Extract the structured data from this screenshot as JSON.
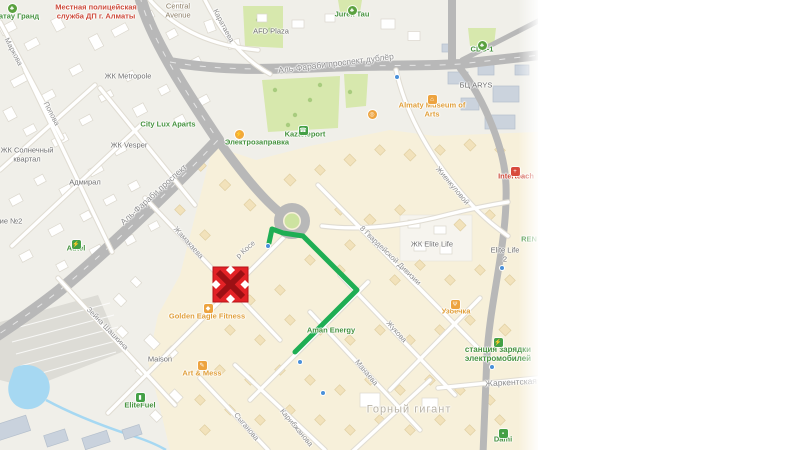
{
  "legend": {
    "notice_icon": "exclamation-circle-icon",
    "blocked_icon": "four-way-arrows-icon",
    "detour_icon": "green-line-icon",
    "blocked_label": "Перекрываемый участок",
    "detour_label": "Объездные пути",
    "colors": {
      "notice_blue": "#4574c6",
      "blocked_red": "#c00d0d",
      "detour_green": "#2eb05e"
    }
  },
  "map": {
    "route_color": "#1fae54",
    "route_points": [
      [
        269,
        243
      ],
      [
        272,
        229
      ],
      [
        283,
        233
      ],
      [
        303,
        236
      ],
      [
        357,
        290
      ],
      [
        295,
        352
      ]
    ],
    "blocked_marker": {
      "x": 230.5,
      "y": 284.5,
      "size": 35,
      "fill": "#e32226",
      "cross": "#9c1014"
    },
    "transit_dots": [
      [
        268,
        246
      ],
      [
        300,
        362
      ],
      [
        323,
        393
      ],
      [
        502,
        268
      ],
      [
        492,
        367
      ],
      [
        397,
        77
      ]
    ],
    "labels": [
      {
        "t": "Местная полицейская\nслужба ДП г. Алматы",
        "x": 96,
        "y": 12,
        "c": "red"
      },
      {
        "t": "атау Гранд",
        "x": 19,
        "y": 17,
        "c": "green"
      },
      {
        "t": "Central\nAvenue",
        "x": 178,
        "y": 11,
        "c": "area"
      },
      {
        "t": "Каратаева",
        "x": 223,
        "y": 26,
        "c": "street",
        "r": 62
      },
      {
        "t": "AFD Plaza",
        "x": 271,
        "y": 32,
        "c": "zk"
      },
      {
        "t": "Jurek Tau",
        "x": 352,
        "y": 15,
        "c": "green"
      },
      {
        "t": "Аль-Фараби проспект дублёр",
        "x": 336,
        "y": 64,
        "c": "street",
        "r": -7,
        "s": 8.5
      },
      {
        "t": "CDC-1",
        "x": 482,
        "y": 50,
        "c": "green"
      },
      {
        "t": "БЦ ARYS",
        "x": 476,
        "y": 86,
        "c": "zk"
      },
      {
        "t": "Almaty Museum of\nArts",
        "x": 432,
        "y": 110,
        "c": "orange"
      },
      {
        "t": "Kazteleport",
        "x": 305,
        "y": 135,
        "c": "green"
      },
      {
        "t": "Электрозаправка",
        "x": 257,
        "y": 143,
        "c": "green"
      },
      {
        "t": "ЖК Metropole",
        "x": 128,
        "y": 77,
        "c": "zk"
      },
      {
        "t": "City Lux Aparts",
        "x": 168,
        "y": 125,
        "c": "green"
      },
      {
        "t": "ЖК Vesper",
        "x": 129,
        "y": 146,
        "c": "zk"
      },
      {
        "t": "ЖК Солнечный\nквартал",
        "x": 27,
        "y": 155,
        "c": "zk"
      },
      {
        "t": "Адмирал",
        "x": 85,
        "y": 183,
        "c": "zk"
      },
      {
        "t": "Маркова",
        "x": 13,
        "y": 52,
        "c": "street",
        "r": 62
      },
      {
        "t": "Попова",
        "x": 51,
        "y": 114,
        "c": "street",
        "r": 62
      },
      {
        "t": "Аль-Фараби проспект",
        "x": 154,
        "y": 195,
        "c": "street",
        "r": -42,
        "s": 8.5
      },
      {
        "t": "ие №2",
        "x": 11,
        "y": 222,
        "c": "zk"
      },
      {
        "t": "Autel",
        "x": 76,
        "y": 249,
        "c": "green"
      },
      {
        "t": "Жамакаева",
        "x": 188,
        "y": 243,
        "c": "street",
        "r": 48
      },
      {
        "t": "р Косе",
        "x": 246,
        "y": 250,
        "c": "street",
        "r": -42
      },
      {
        "t": "8 Гвардейской Дивизии",
        "x": 390,
        "y": 256,
        "c": "street",
        "r": 44
      },
      {
        "t": "Жиенкуловой",
        "x": 452,
        "y": 186,
        "c": "street",
        "r": 50
      },
      {
        "t": "Interteach",
        "x": 516,
        "y": 177,
        "c": "red"
      },
      {
        "t": "ЖК Elite Life",
        "x": 432,
        "y": 245,
        "c": "zk"
      },
      {
        "t": "Elite Life 2",
        "x": 505,
        "y": 255,
        "c": "zk"
      },
      {
        "t": "REN",
        "x": 529,
        "y": 240,
        "c": "green"
      },
      {
        "t": "Зейна Шашкина",
        "x": 107,
        "y": 329,
        "c": "street",
        "r": 46
      },
      {
        "t": "Maison",
        "x": 160,
        "y": 360,
        "c": "zk"
      },
      {
        "t": "Golden Eagle Fitness",
        "x": 207,
        "y": 317,
        "c": "orange"
      },
      {
        "t": "Art & Mess",
        "x": 202,
        "y": 374,
        "c": "orange"
      },
      {
        "t": "EliteFuel",
        "x": 140,
        "y": 406,
        "c": "green"
      },
      {
        "t": "Сыганова",
        "x": 246,
        "y": 427,
        "c": "street",
        "r": 50
      },
      {
        "t": "Карибжанова",
        "x": 296,
        "y": 428,
        "c": "street",
        "r": 50
      },
      {
        "t": "Манаева",
        "x": 366,
        "y": 373,
        "c": "street",
        "r": 50
      },
      {
        "t": "Жукова",
        "x": 396,
        "y": 332,
        "c": "street",
        "r": 48
      },
      {
        "t": "Узбечка",
        "x": 456,
        "y": 312,
        "c": "orange"
      },
      {
        "t": "станция зарядки\nэлектромобилей",
        "x": 498,
        "y": 354,
        "c": "green",
        "s": 8
      },
      {
        "t": "Жаркентская",
        "x": 511,
        "y": 383,
        "c": "street",
        "r": -3,
        "s": 8.5
      },
      {
        "t": "Горный гигант",
        "x": 409,
        "y": 410,
        "c": "district",
        "s": 11
      },
      {
        "t": "Dami",
        "x": 503,
        "y": 440,
        "c": "green"
      },
      {
        "t": "Aman Energy",
        "x": 331,
        "y": 331,
        "c": "green"
      }
    ],
    "poi_icons": [
      {
        "k": "tree",
        "x": 352,
        "y": 6
      },
      {
        "k": "tree",
        "x": 482,
        "y": 41
      },
      {
        "k": "tree",
        "x": 12,
        "y": 4
      },
      {
        "k": "museum",
        "x": 432,
        "y": 95
      },
      {
        "k": "lightning",
        "x": 239,
        "y": 130
      },
      {
        "k": "ev",
        "x": 76,
        "y": 240
      },
      {
        "k": "telecom",
        "x": 303,
        "y": 126
      },
      {
        "k": "ev",
        "x": 498,
        "y": 338
      },
      {
        "k": "fuel",
        "x": 140,
        "y": 393
      },
      {
        "k": "shop",
        "x": 503,
        "y": 429
      },
      {
        "k": "fitness",
        "x": 208,
        "y": 304
      },
      {
        "k": "art",
        "x": 202,
        "y": 361
      },
      {
        "k": "food",
        "x": 455,
        "y": 300
      },
      {
        "k": "medical",
        "x": 515,
        "y": 167
      },
      {
        "k": "ferris",
        "x": 372,
        "y": 110
      }
    ]
  }
}
